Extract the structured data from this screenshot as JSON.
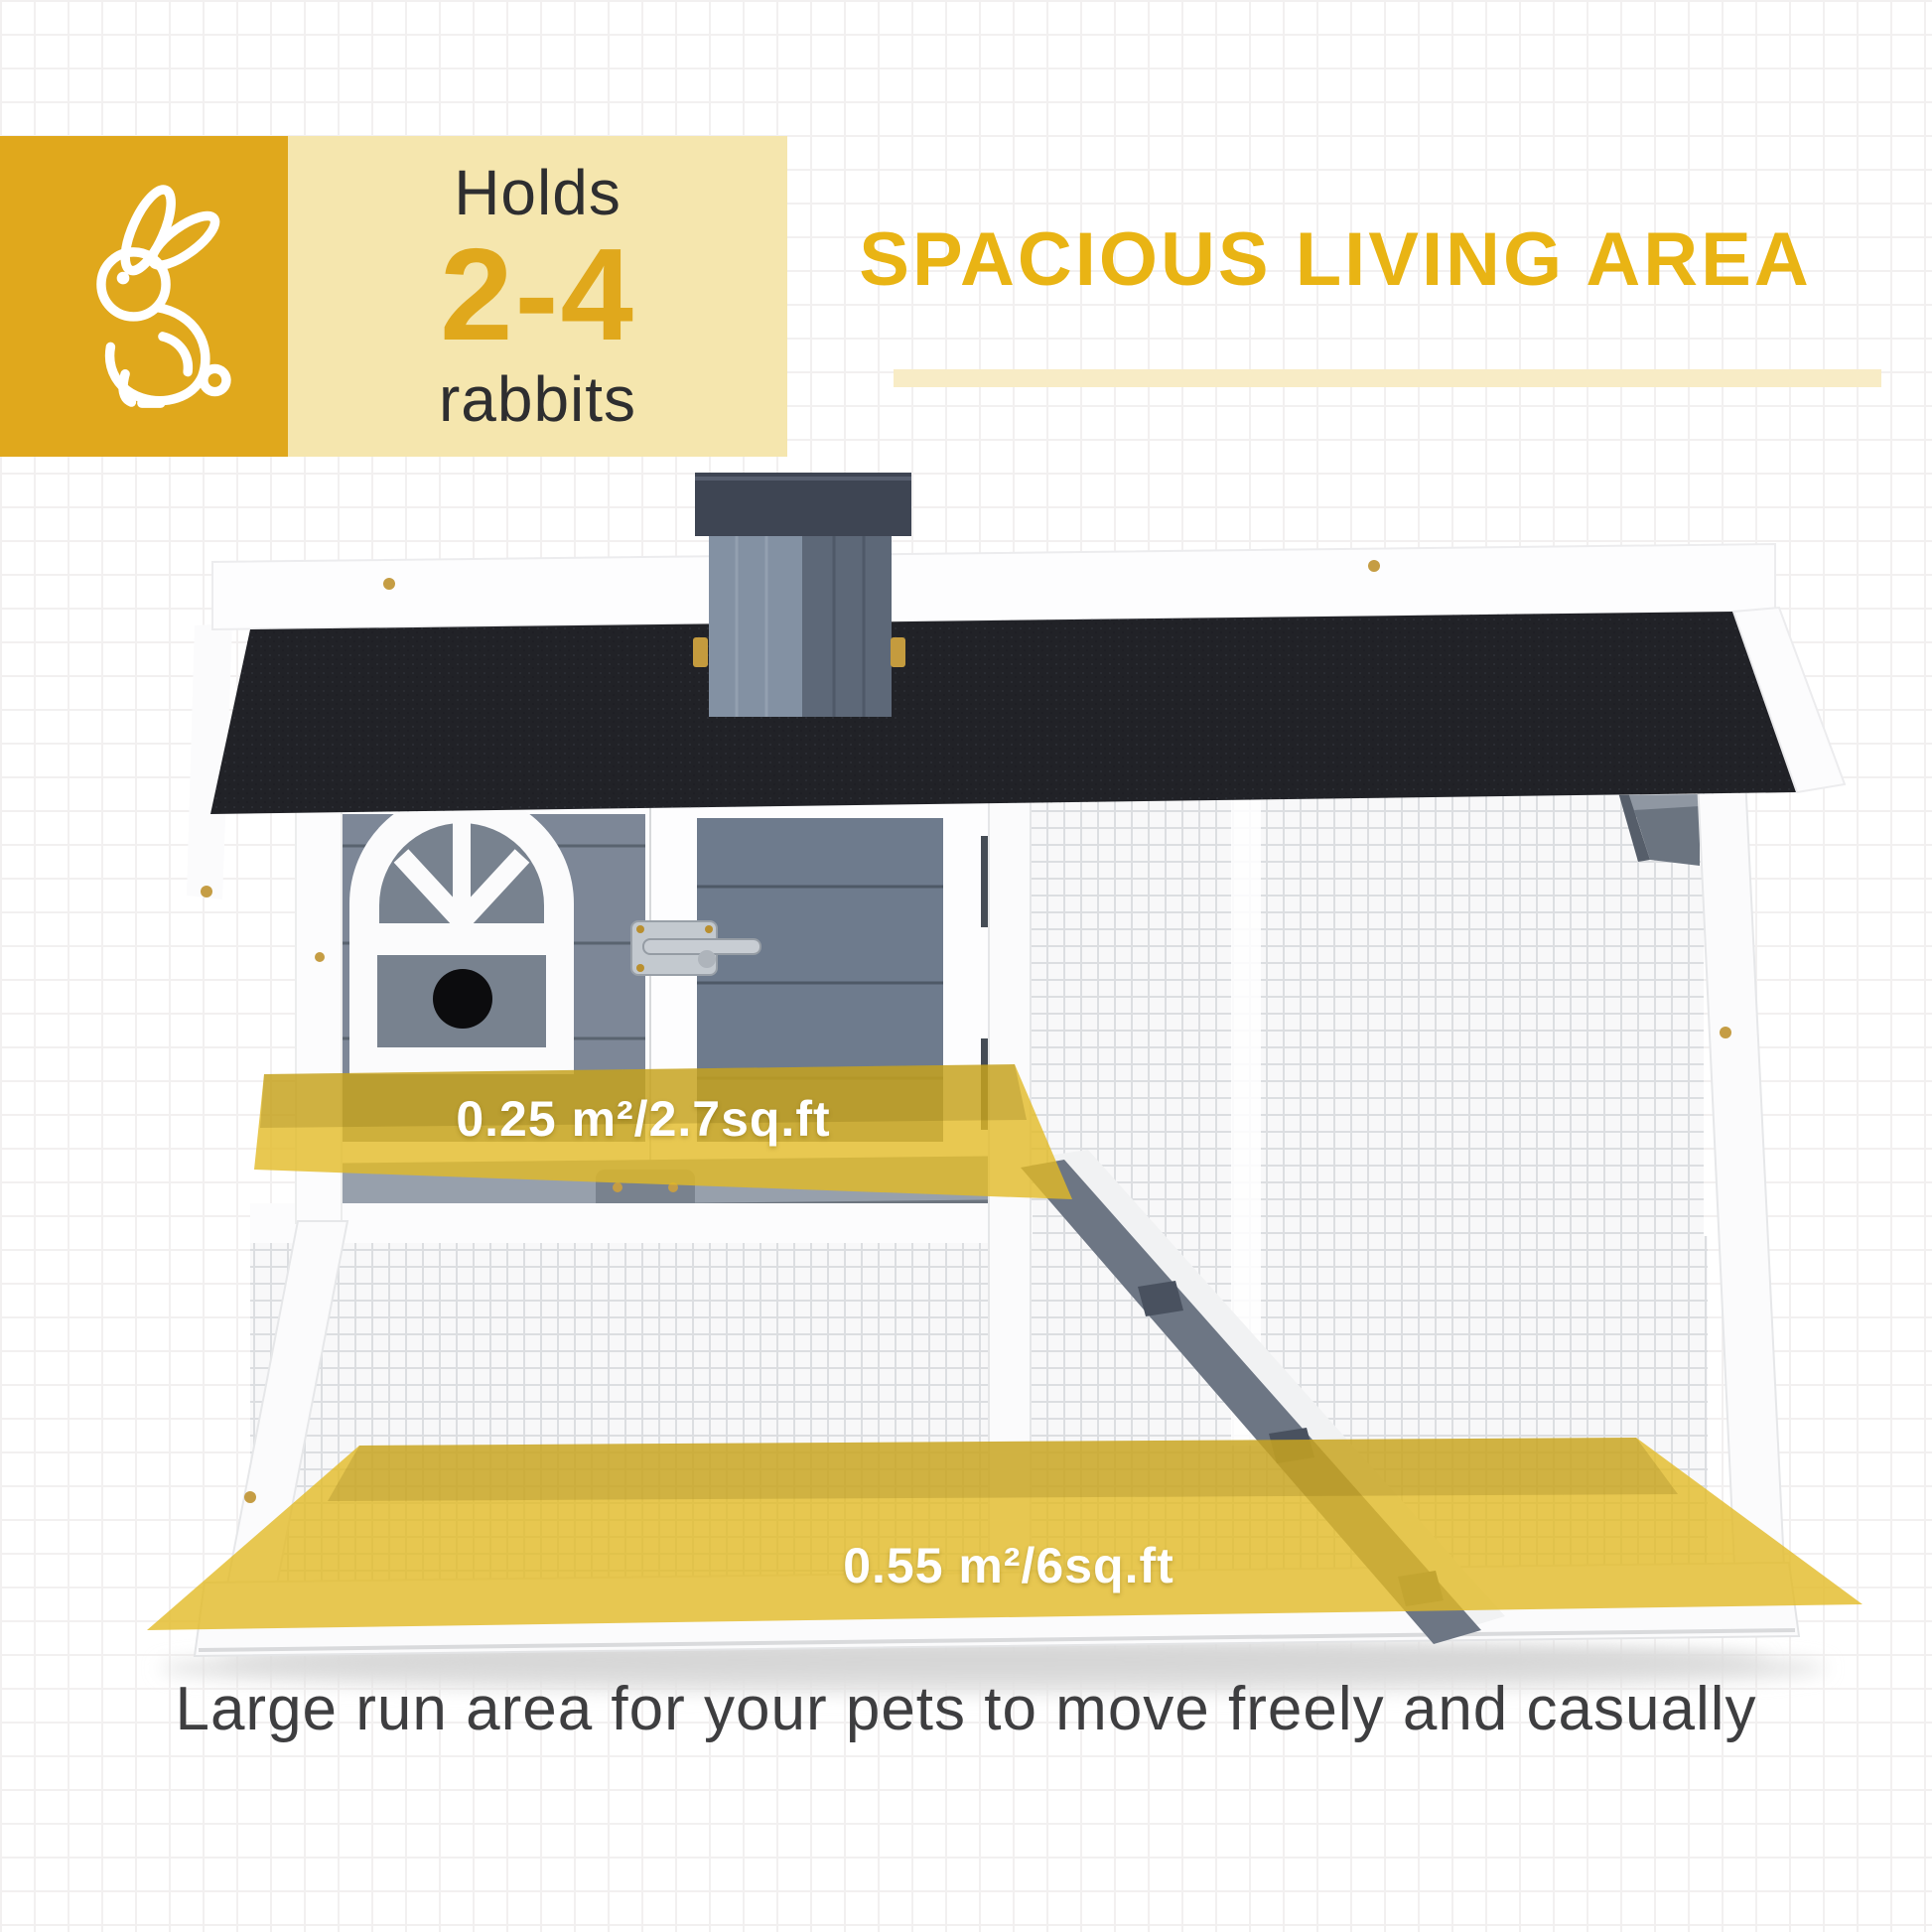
{
  "badge": {
    "holds": "Holds",
    "count": "2-4",
    "animal": "rabbits"
  },
  "header": {
    "title": "SPACIOUS LIVING AREA"
  },
  "hutch": {
    "upper_area_label": "0.25 m²/2.7sq.ft",
    "lower_area_label": "0.55 m²/6sq.ft"
  },
  "caption": "Large run area for your pets to move freely and casually",
  "colors": {
    "gold": "#e0a81c",
    "cream": "#f5e6ae",
    "titleGold": "#e9b414",
    "underline": "#f8ecc6",
    "overlayYellow": "rgba(226,186,38,0.8)",
    "captionGray": "#3e3e40"
  }
}
